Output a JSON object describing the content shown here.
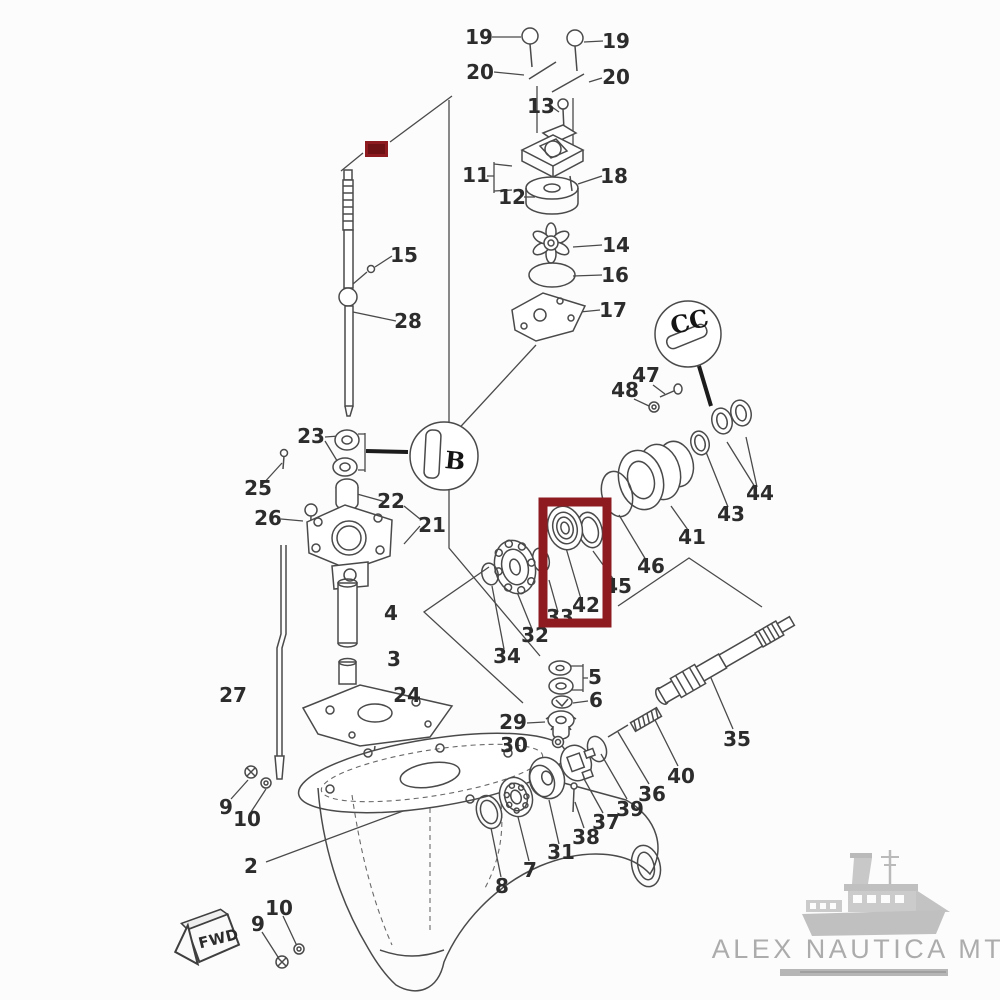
{
  "diagram": {
    "type": "exploded-parts-diagram",
    "subject": "outboard motor lower unit gearbox parts schematic",
    "line_color": "#4a4a4a",
    "background": "#fcfcfc"
  },
  "parts": [
    {
      "label": "19",
      "x": 479,
      "y": 44
    },
    {
      "label": "19",
      "x": 616,
      "y": 48
    },
    {
      "label": "20",
      "x": 480,
      "y": 79
    },
    {
      "label": "20",
      "x": 616,
      "y": 84
    },
    {
      "label": "13",
      "x": 541,
      "y": 113
    },
    {
      "label": "11",
      "x": 476,
      "y": 182
    },
    {
      "label": "12",
      "x": 512,
      "y": 204
    },
    {
      "label": "18",
      "x": 614,
      "y": 183
    },
    {
      "label": "14",
      "x": 616,
      "y": 252
    },
    {
      "label": "16",
      "x": 615,
      "y": 282
    },
    {
      "label": "17",
      "x": 613,
      "y": 317
    },
    {
      "label": "15",
      "x": 404,
      "y": 262
    },
    {
      "label": "28",
      "x": 408,
      "y": 328
    },
    {
      "label": "23",
      "x": 311,
      "y": 443
    },
    {
      "label": "25",
      "x": 258,
      "y": 495
    },
    {
      "label": "22",
      "x": 391,
      "y": 508
    },
    {
      "label": "26",
      "x": 268,
      "y": 525
    },
    {
      "label": "21",
      "x": 432,
      "y": 532
    },
    {
      "label": "47",
      "x": 646,
      "y": 382
    },
    {
      "label": "48",
      "x": 625,
      "y": 397
    },
    {
      "label": "44",
      "x": 760,
      "y": 500
    },
    {
      "label": "43",
      "x": 731,
      "y": 521
    },
    {
      "label": "41",
      "x": 692,
      "y": 544
    },
    {
      "label": "46",
      "x": 651,
      "y": 573
    },
    {
      "label": "45",
      "x": 618,
      "y": 593
    },
    {
      "label": "42",
      "x": 586,
      "y": 612
    },
    {
      "label": "33",
      "x": 560,
      "y": 624
    },
    {
      "label": "32",
      "x": 535,
      "y": 642
    },
    {
      "label": "34",
      "x": 507,
      "y": 663
    },
    {
      "label": "4",
      "x": 391,
      "y": 620
    },
    {
      "label": "3",
      "x": 394,
      "y": 666
    },
    {
      "label": "24",
      "x": 407,
      "y": 702
    },
    {
      "label": "27",
      "x": 233,
      "y": 702
    },
    {
      "label": "5",
      "x": 595,
      "y": 684
    },
    {
      "label": "6",
      "x": 596,
      "y": 707
    },
    {
      "label": "29",
      "x": 513,
      "y": 729
    },
    {
      "label": "30",
      "x": 514,
      "y": 752
    },
    {
      "label": "35",
      "x": 737,
      "y": 746
    },
    {
      "label": "40",
      "x": 681,
      "y": 783
    },
    {
      "label": "36",
      "x": 652,
      "y": 801
    },
    {
      "label": "39",
      "x": 630,
      "y": 816
    },
    {
      "label": "37",
      "x": 606,
      "y": 829
    },
    {
      "label": "38",
      "x": 586,
      "y": 844
    },
    {
      "label": "31",
      "x": 561,
      "y": 859
    },
    {
      "label": "7",
      "x": 530,
      "y": 877
    },
    {
      "label": "8",
      "x": 502,
      "y": 893
    },
    {
      "label": "9",
      "x": 226,
      "y": 814
    },
    {
      "label": "10",
      "x": 247,
      "y": 826
    },
    {
      "label": "10",
      "x": 279,
      "y": 915
    },
    {
      "label": "9",
      "x": 258,
      "y": 931
    },
    {
      "label": "2",
      "x": 251,
      "y": 873
    }
  ],
  "highlights": {
    "box": {
      "color": "#8d1b20",
      "around_part": "42"
    },
    "filled_rect": {
      "color": "#8d1b20",
      "inner_color": "#6e1216",
      "covers_part": "1"
    }
  },
  "annotations": {
    "fwd_label": "FWD",
    "grease_icon_b": "B",
    "grease_icon_cc": "CC"
  },
  "branding": {
    "name": "ALEX NAUTICA MT",
    "color": "#a8a8a8"
  }
}
